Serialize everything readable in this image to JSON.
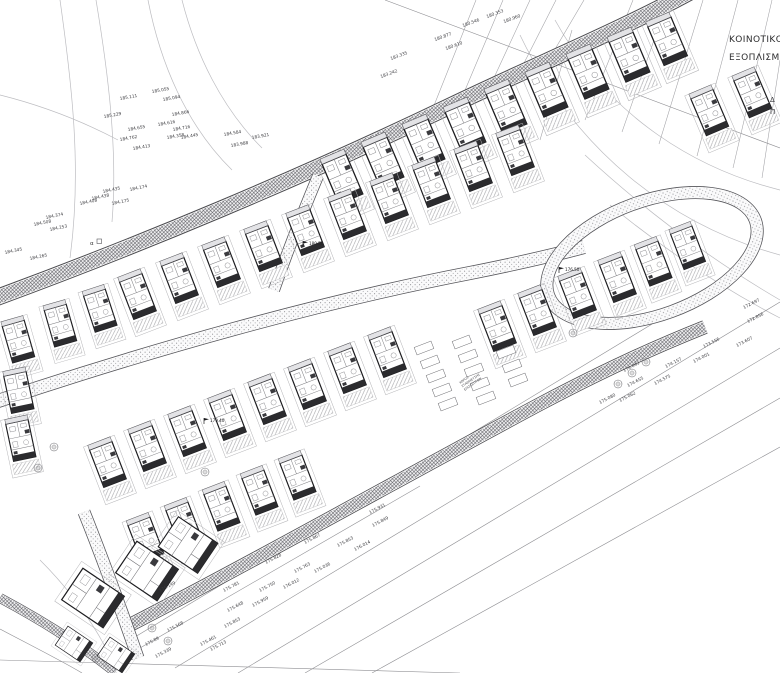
{
  "plan": {
    "annotations": {
      "community_line1": "ΚΟΙΝΟΤΙΚΟ",
      "community_line2": "ΕΞΟΠΛΙΣΜ",
      "edge_partial_1": "Δ",
      "edge_partial_2": "Π",
      "marker_alpha": "α",
      "parking_lines": [
        "ΧΩΡΟΣ",
        "ΣΤΑΘΜΕΥΣΗΣ",
        "ΕΠΙΣΚΕΠΤΩΝ"
      ]
    },
    "parking_text": {
      "x": 460,
      "y": 384,
      "r": -35
    },
    "spot_labels": [
      {
        "t": "185.111",
        "x": 120,
        "y": 100,
        "r": -10
      },
      {
        "t": "185.055",
        "x": 152,
        "y": 93,
        "r": -10
      },
      {
        "t": "185.094",
        "x": 163,
        "y": 101,
        "r": -10
      },
      {
        "t": "185.229",
        "x": 104,
        "y": 118,
        "r": -10
      },
      {
        "t": "184.866",
        "x": 172,
        "y": 116,
        "r": -10
      },
      {
        "t": "184.616",
        "x": 158,
        "y": 126,
        "r": -10
      },
      {
        "t": "184.716",
        "x": 173,
        "y": 131,
        "r": -10
      },
      {
        "t": "184.655",
        "x": 128,
        "y": 131,
        "r": -10
      },
      {
        "t": "184.762",
        "x": 120,
        "y": 141,
        "r": -10
      },
      {
        "t": "184.413",
        "x": 133,
        "y": 150,
        "r": -10
      },
      {
        "t": "184.358",
        "x": 167,
        "y": 139,
        "r": -10
      },
      {
        "t": "184.445",
        "x": 181,
        "y": 139,
        "r": -10
      },
      {
        "t": "184.584",
        "x": 224,
        "y": 136,
        "r": -10
      },
      {
        "t": "183.921",
        "x": 252,
        "y": 139,
        "r": -10
      },
      {
        "t": "183.988",
        "x": 231,
        "y": 147,
        "r": -10
      },
      {
        "t": "184.435",
        "x": 103,
        "y": 193,
        "r": -12
      },
      {
        "t": "184.174",
        "x": 130,
        "y": 191,
        "r": -12
      },
      {
        "t": "184.438",
        "x": 92,
        "y": 200,
        "r": -12
      },
      {
        "t": "184.408",
        "x": 80,
        "y": 205,
        "r": -12
      },
      {
        "t": "184.175",
        "x": 112,
        "y": 205,
        "r": -12
      },
      {
        "t": "184.374",
        "x": 46,
        "y": 219,
        "r": -12
      },
      {
        "t": "184.508",
        "x": 34,
        "y": 226,
        "r": -12
      },
      {
        "t": "184.253",
        "x": 50,
        "y": 231,
        "r": -12
      },
      {
        "t": "184.345",
        "x": 5,
        "y": 254,
        "r": -12
      },
      {
        "t": "184.265",
        "x": 30,
        "y": 260,
        "r": -12
      },
      {
        "t": "180.353",
        "x": 487,
        "y": 18,
        "r": -20
      },
      {
        "t": "180.546",
        "x": 463,
        "y": 27,
        "r": -20
      },
      {
        "t": "180.960",
        "x": 504,
        "y": 23,
        "r": -20
      },
      {
        "t": "180.877",
        "x": 435,
        "y": 41,
        "r": -20
      },
      {
        "t": "180.610",
        "x": 446,
        "y": 50,
        "r": -20
      },
      {
        "t": "183.335",
        "x": 391,
        "y": 60,
        "r": -20
      },
      {
        "t": "183.242",
        "x": 381,
        "y": 78,
        "r": -20
      },
      {
        "t": "173.556",
        "x": 704,
        "y": 348,
        "r": -27
      },
      {
        "t": "173.607",
        "x": 737,
        "y": 347,
        "r": -27
      },
      {
        "t": "174.157",
        "x": 666,
        "y": 368,
        "r": -27
      },
      {
        "t": "174.001",
        "x": 694,
        "y": 363,
        "r": -27
      },
      {
        "t": "174.575",
        "x": 655,
        "y": 385,
        "r": -27
      },
      {
        "t": "174.655",
        "x": 628,
        "y": 387,
        "r": -27
      },
      {
        "t": "175.080",
        "x": 600,
        "y": 404,
        "r": -27
      },
      {
        "t": "175.062",
        "x": 620,
        "y": 402,
        "r": -27
      },
      {
        "t": "174.043",
        "x": 624,
        "y": 372,
        "r": -27
      },
      {
        "t": "172.697",
        "x": 744,
        "y": 309,
        "r": -27
      },
      {
        "t": "172.856",
        "x": 748,
        "y": 323,
        "r": -27
      },
      {
        "t": "175.931",
        "x": 370,
        "y": 514,
        "r": -28
      },
      {
        "t": "175.849",
        "x": 373,
        "y": 527,
        "r": -28
      },
      {
        "t": "175.867",
        "x": 305,
        "y": 544,
        "r": -28
      },
      {
        "t": "175.853",
        "x": 338,
        "y": 547,
        "r": -28
      },
      {
        "t": "176.014",
        "x": 355,
        "y": 551,
        "r": -28
      },
      {
        "t": "175.828",
        "x": 266,
        "y": 564,
        "r": -28
      },
      {
        "t": "175.763",
        "x": 295,
        "y": 573,
        "r": -28
      },
      {
        "t": "175.036",
        "x": 315,
        "y": 573,
        "r": -28
      },
      {
        "t": "175.781",
        "x": 224,
        "y": 592,
        "r": -28
      },
      {
        "t": "175.750",
        "x": 260,
        "y": 592,
        "r": -28
      },
      {
        "t": "176.012",
        "x": 284,
        "y": 589,
        "r": -28
      },
      {
        "t": "175.959",
        "x": 253,
        "y": 607,
        "r": -28
      },
      {
        "t": "175.648",
        "x": 228,
        "y": 612,
        "r": -28
      },
      {
        "t": "175.853",
        "x": 225,
        "y": 628,
        "r": -28
      },
      {
        "t": "175.461",
        "x": 201,
        "y": 646,
        "r": -28
      },
      {
        "t": "175.713",
        "x": 211,
        "y": 651,
        "r": -28
      },
      {
        "t": "175.339",
        "x": 156,
        "y": 658,
        "r": -28
      },
      {
        "t": "175.568",
        "x": 168,
        "y": 632,
        "r": -28
      },
      {
        "t": "175.89",
        "x": 146,
        "y": 646,
        "r": -28
      },
      {
        "t": "175.149",
        "x": 160,
        "y": 592,
        "r": -28
      }
    ],
    "flag_labels": [
      {
        "t": "180.50",
        "x": 303,
        "y": 247
      },
      {
        "t": "179.40",
        "x": 204,
        "y": 424
      },
      {
        "t": "176.50",
        "x": 559,
        "y": 273
      }
    ],
    "houses": [
      {
        "x": 345,
        "y": 185,
        "r": -23,
        "s": 1.08
      },
      {
        "x": 386,
        "y": 168,
        "r": -23,
        "s": 1.08
      },
      {
        "x": 427,
        "y": 150,
        "r": -23,
        "s": 1.08
      },
      {
        "x": 468,
        "y": 133,
        "r": -23,
        "s": 1.08
      },
      {
        "x": 509,
        "y": 115,
        "r": -23,
        "s": 1.08
      },
      {
        "x": 550,
        "y": 98,
        "r": -23,
        "s": 1.08
      },
      {
        "x": 591,
        "y": 80,
        "r": -23,
        "s": 1.08
      },
      {
        "x": 632,
        "y": 63,
        "r": -23,
        "s": 1.08
      },
      {
        "x": 670,
        "y": 47,
        "r": -23,
        "s": 1.05
      },
      {
        "x": 712,
        "y": 118,
        "r": -23,
        "s": 1.0
      },
      {
        "x": 755,
        "y": 100,
        "r": -23,
        "s": 1.0
      },
      {
        "x": 140,
        "y": 302,
        "r": -21,
        "s": 1.0
      },
      {
        "x": 182,
        "y": 286,
        "r": -21,
        "s": 1.0
      },
      {
        "x": 224,
        "y": 270,
        "r": -21,
        "s": 1.0
      },
      {
        "x": 266,
        "y": 254,
        "r": -21,
        "s": 1.0
      },
      {
        "x": 308,
        "y": 238,
        "r": -21,
        "s": 1.0
      },
      {
        "x": 350,
        "y": 222,
        "r": -21,
        "s": 1.0
      },
      {
        "x": 392,
        "y": 206,
        "r": -21,
        "s": 1.0
      },
      {
        "x": 434,
        "y": 190,
        "r": -21,
        "s": 1.0
      },
      {
        "x": 476,
        "y": 174,
        "r": -21,
        "s": 1.0
      },
      {
        "x": 518,
        "y": 158,
        "r": -21,
        "s": 1.0
      },
      {
        "x": 20,
        "y": 347,
        "r": -16,
        "s": 0.95
      },
      {
        "x": 62,
        "y": 331,
        "r": -16,
        "s": 0.95
      },
      {
        "x": 102,
        "y": 316,
        "r": -18,
        "s": 0.95
      },
      {
        "x": 500,
        "y": 334,
        "r": -21,
        "s": 1.0
      },
      {
        "x": 540,
        "y": 318,
        "r": -21,
        "s": 1.0
      },
      {
        "x": 580,
        "y": 301,
        "r": -21,
        "s": 1.0
      },
      {
        "x": 620,
        "y": 285,
        "r": -21,
        "s": 1.0
      },
      {
        "x": 656,
        "y": 269,
        "r": -21,
        "s": 0.98
      },
      {
        "x": 690,
        "y": 253,
        "r": -21,
        "s": 0.95
      },
      {
        "x": 110,
        "y": 470,
        "r": -21,
        "s": 1.0
      },
      {
        "x": 150,
        "y": 454,
        "r": -21,
        "s": 1.0
      },
      {
        "x": 190,
        "y": 439,
        "r": -21,
        "s": 1.0
      },
      {
        "x": 230,
        "y": 423,
        "r": -21,
        "s": 1.0
      },
      {
        "x": 270,
        "y": 407,
        "r": -21,
        "s": 1.0
      },
      {
        "x": 310,
        "y": 392,
        "r": -21,
        "s": 1.0
      },
      {
        "x": 350,
        "y": 376,
        "r": -21,
        "s": 1.0
      },
      {
        "x": 390,
        "y": 360,
        "r": -21,
        "s": 1.0
      },
      {
        "x": 20,
        "y": 398,
        "r": -12,
        "s": 0.95
      },
      {
        "x": 22,
        "y": 446,
        "r": -12,
        "s": 0.95
      },
      {
        "x": 148,
        "y": 545,
        "r": -21,
        "s": 0.98
      },
      {
        "x": 186,
        "y": 530,
        "r": -21,
        "s": 0.98
      },
      {
        "x": 224,
        "y": 514,
        "r": -21,
        "s": 0.98
      },
      {
        "x": 262,
        "y": 498,
        "r": -21,
        "s": 0.98
      },
      {
        "x": 300,
        "y": 483,
        "r": -21,
        "s": 0.98
      }
    ],
    "buildings": [
      {
        "x": 93,
        "y": 598,
        "r": -56,
        "s": 1.0
      },
      {
        "x": 147,
        "y": 571,
        "r": -56,
        "s": 1.0
      },
      {
        "x": 188,
        "y": 545,
        "r": -56,
        "s": 0.95
      },
      {
        "x": 74,
        "y": 644,
        "r": -56,
        "s": 0.6
      },
      {
        "x": 116,
        "y": 655,
        "r": -56,
        "s": 0.6
      }
    ],
    "trees": [
      {
        "x": 632,
        "y": 373
      },
      {
        "x": 646,
        "y": 362
      },
      {
        "x": 618,
        "y": 384
      },
      {
        "x": 54,
        "y": 447
      },
      {
        "x": 38,
        "y": 468
      },
      {
        "x": 152,
        "y": 628
      },
      {
        "x": 168,
        "y": 641
      },
      {
        "x": 96,
        "y": 658
      },
      {
        "x": 205,
        "y": 472
      },
      {
        "x": 573,
        "y": 333
      }
    ],
    "stalls": [
      {
        "x": 424,
        "y": 348
      },
      {
        "x": 430,
        "y": 362
      },
      {
        "x": 436,
        "y": 376
      },
      {
        "x": 442,
        "y": 390
      },
      {
        "x": 448,
        "y": 404
      },
      {
        "x": 462,
        "y": 342
      },
      {
        "x": 468,
        "y": 356
      },
      {
        "x": 474,
        "y": 370
      },
      {
        "x": 480,
        "y": 384
      },
      {
        "x": 486,
        "y": 398
      },
      {
        "x": 506,
        "y": 352
      },
      {
        "x": 512,
        "y": 366
      },
      {
        "x": 518,
        "y": 380
      }
    ],
    "linework": {
      "contours": [
        "M 555,20 C 610,120 700,170 780,190",
        "M 520,35 C 575,150 670,225 780,255",
        "M 585,155 C 650,215 715,262 780,300",
        "M 610,205 C 665,250 722,288 780,318",
        "M 60,0 C 72,85 82,170 70,258",
        "M 96,0 C 108,72 118,150 112,222",
        "M 148,0 C 160,62 186,125 232,170",
        "M 182,0 C 196,55 222,108 262,148",
        "M 0,95 C 40,105 80,120 118,140",
        "M 40,560 C 70,590 95,625 112,660"
      ],
      "parcels": [
        "M 130,640 L 700,295",
        "M 175,668 L 780,302",
        "M 238,673 L 780,348",
        "M 305,673 L 780,398",
        "M 372,673 L 780,447",
        "M 140,648 L 420,486",
        "M 0,597 C 45,620 85,646 116,672",
        "M 0,629 C 32,646 62,661 82,673",
        "M 0,660 L 460,673",
        "M 385,0 L 780,148"
      ],
      "fan": [
        "M 433,108 L 476,0",
        "M 463,95 L 503,0",
        "M 492,82 L 530,0",
        "M 521,69 L 556,0",
        "M 551,56 L 584,0",
        "M 585,120 L 633,0",
        "M 622,132 L 668,0",
        "M 659,144 L 703,0",
        "M 697,156 L 738,0",
        "M 733,168 L 772,0",
        "M 762,178 L 780,60",
        "M 540,140 L 572,30"
      ]
    }
  }
}
